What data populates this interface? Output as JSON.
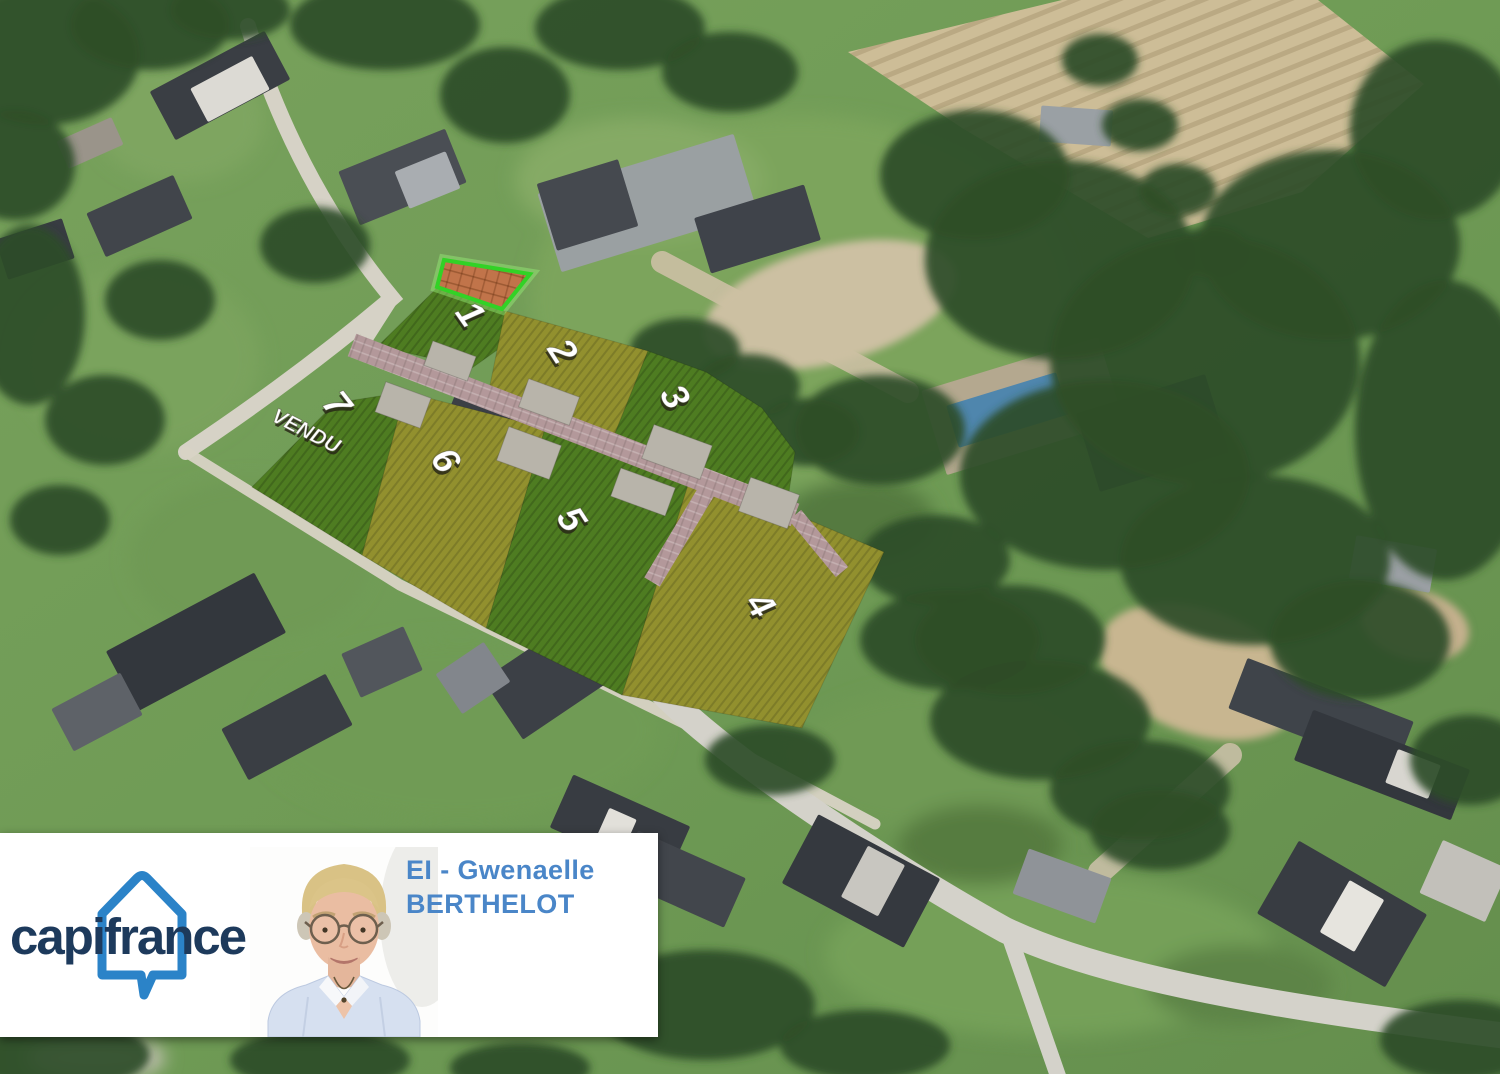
{
  "banner": {
    "brand_wordmark": "capifrance",
    "agent_line1": "EI - Gwenaelle",
    "agent_line2": "BERTHELOT"
  },
  "lots": [
    {
      "number": "1"
    },
    {
      "number": "2"
    },
    {
      "number": "3"
    },
    {
      "number": "4"
    },
    {
      "number": "5"
    },
    {
      "number": "6"
    },
    {
      "number": "7",
      "status": "VENDU"
    }
  ],
  "colors": {
    "parcel_dark_green": "#4e7c21",
    "parcel_olive": "#92902e",
    "driveway_paving": "#b3989a",
    "building_pad": "#b8b4aa",
    "highlight_plot_border": "#32d226",
    "highlight_plot_soil": "#c1744a",
    "lot_label": "#ffffff",
    "brand_navy": "#1d3a5c",
    "brand_blue": "#2b83c8",
    "agent_text_blue": "#4a86c8"
  }
}
